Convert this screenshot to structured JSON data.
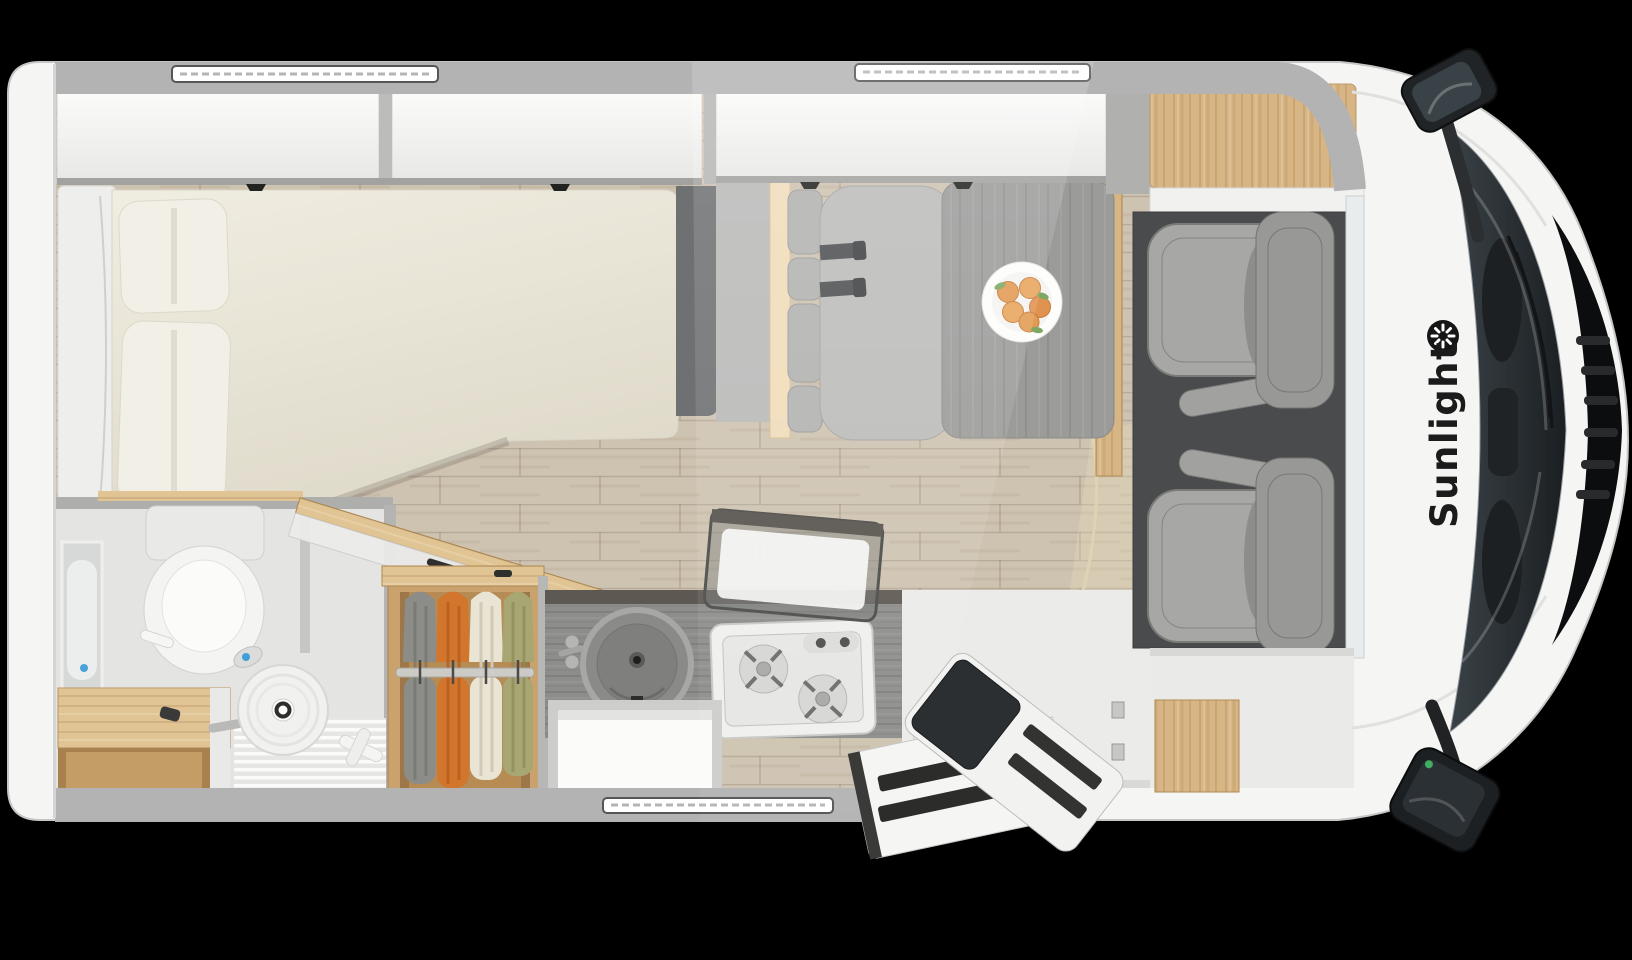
{
  "branding": {
    "logo_text": "Sunlight",
    "logo_icon": "sunburst-icon",
    "logo_text_color": "#1b1b1b"
  },
  "scene": {
    "type": "motorhome-floorplan-top-view",
    "background_color": "#000000",
    "body_color": "#f5f5f4",
    "wall_color": "#b3b3b3"
  },
  "palette": {
    "floor_wood": "#cec3b1",
    "oak_light": "#d8b686",
    "oak_dark": "#b68b54",
    "oak_pale_trim": "#f0dcba",
    "bed_cream": "#eae5d7",
    "cabinet_white": "#f7f7f5",
    "counter_gray": "#8d8d8b",
    "walnut_dark": "#5e5852",
    "table_gray": "#9b9c9a",
    "seat_gray": "#a7a7a5",
    "cushion_gray": "#b2b2b0",
    "cab_mat": "#494b4d",
    "glass_dark": "#2b3034",
    "cloth_gray": "#8c8c88",
    "cloth_orange": "#d2752d",
    "cloth_cream": "#e9e4d4",
    "cloth_olive": "#a8a672",
    "fruit_peach": "#e39a52",
    "accent_blue": "#4aa3d8"
  },
  "regions": {
    "bedroom": {
      "name": "rear-bedroom",
      "items": [
        "overhead-cabinet-left",
        "overhead-cabinet-right",
        "bed",
        "pillow-top",
        "pillow-bottom",
        "headboard-panel"
      ]
    },
    "bathroom": {
      "name": "bathroom",
      "items": [
        "mirror",
        "toilet",
        "shower-head",
        "shower-floor",
        "wood-bench",
        "open-wood-door"
      ]
    },
    "wardrobe": {
      "name": "wardrobe",
      "items": [
        "hanging-clothes-gray",
        "hanging-clothes-orange",
        "hanging-clothes-cream",
        "hanging-clothes-olive",
        "clothes-rail"
      ]
    },
    "kitchen": {
      "name": "kitchen",
      "items": [
        "round-sink",
        "tap-knobs",
        "two-burner-stove",
        "open-glass-lid",
        "under-sink-cabinet",
        "cutlery-drawer"
      ]
    },
    "dinette": {
      "name": "dinette",
      "items": [
        "bench-seat",
        "backrest-cushions",
        "seat-belts",
        "table",
        "fruit-plate"
      ]
    },
    "cab": {
      "name": "driver-cab",
      "items": [
        "overcab-wood-panel",
        "floor-mat",
        "passenger-seat",
        "driver-seat",
        "windshield",
        "dashboard",
        "grille",
        "side-mirror-top",
        "side-mirror-bottom"
      ]
    },
    "entry": {
      "name": "entry",
      "items": [
        "open-entry-door",
        "entry-step",
        "wood-step-floor"
      ]
    },
    "shell": {
      "name": "vehicle-shell",
      "items": [
        "roof-window-rear",
        "roof-window-dinette",
        "roof-window-bottom",
        "top-wall",
        "bottom-wall",
        "light-shaft"
      ]
    }
  }
}
